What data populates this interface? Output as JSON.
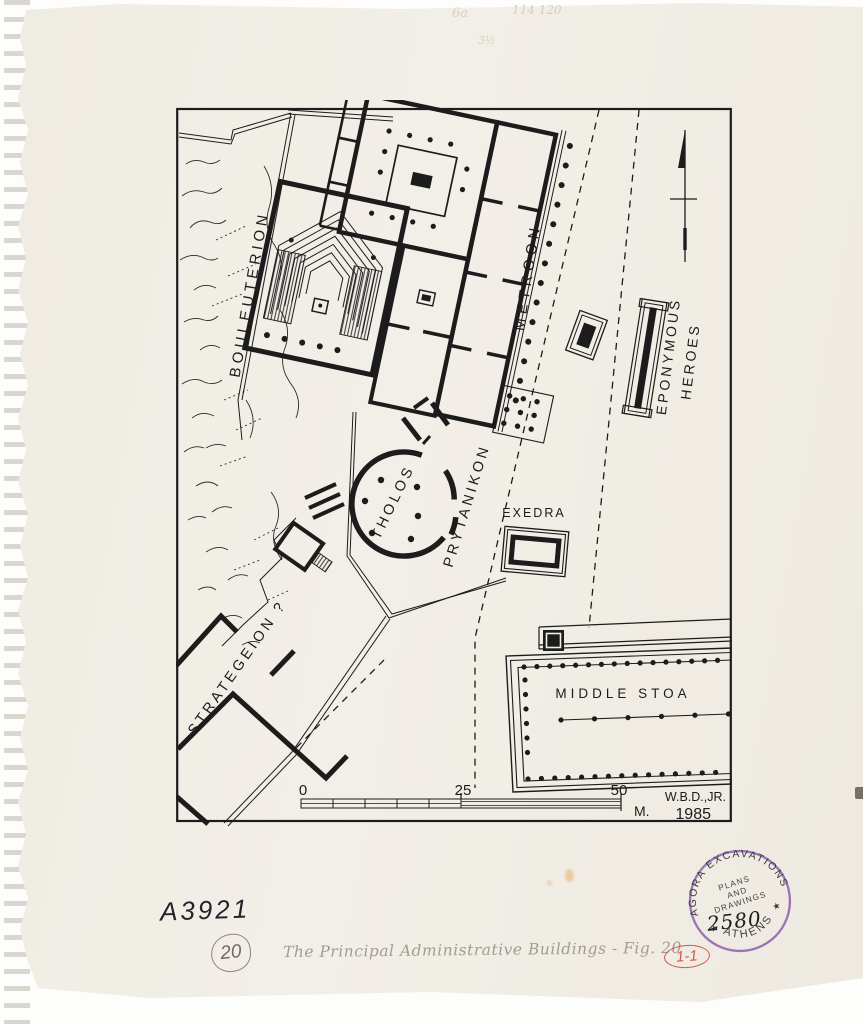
{
  "document": {
    "type_hint": "scanned archaeological site plan, Athenian Agora",
    "colors": {
      "paper": "#f1eee6",
      "ink": "#1c1c1c",
      "pencil": "#a29c90",
      "stamp_purple": "#8d5fae",
      "annotation_red": "#d8564a"
    }
  },
  "map": {
    "labels": {
      "bouleuterion": "BOULEUTERION",
      "metroon": "METROON",
      "eponymous_line1": "EPONYMOUS",
      "eponymous_line2": "HEROES",
      "tholos": "THOLOS",
      "prytanikon": "PRYTANIKON",
      "exedra": "EXEDRA",
      "strategeion": "STRATEGEION ?",
      "middle_stoa": "MIDDLE STOA"
    },
    "scale": {
      "tick0": "0",
      "tick25": "25",
      "tick50": "50",
      "unit": "M.",
      "author": "W.B.D.,JR.",
      "year": "1985"
    }
  },
  "stamp": {
    "arc_top": "AGORA EXCAVATIONS",
    "center_line1": "PLANS",
    "center_line2": "AND",
    "center_line3": "DRAWINGS",
    "number": "2580",
    "arc_bottom": "ATHENS",
    "star": "★"
  },
  "annotations": {
    "faint_1": "6a",
    "faint_2": "114 120",
    "faint_3": "3½",
    "inventory_number": "A3921",
    "circled_number": "20",
    "caption": "The Principal Administrative Buildings - Fig. 20",
    "plate_ref": "1-1"
  }
}
